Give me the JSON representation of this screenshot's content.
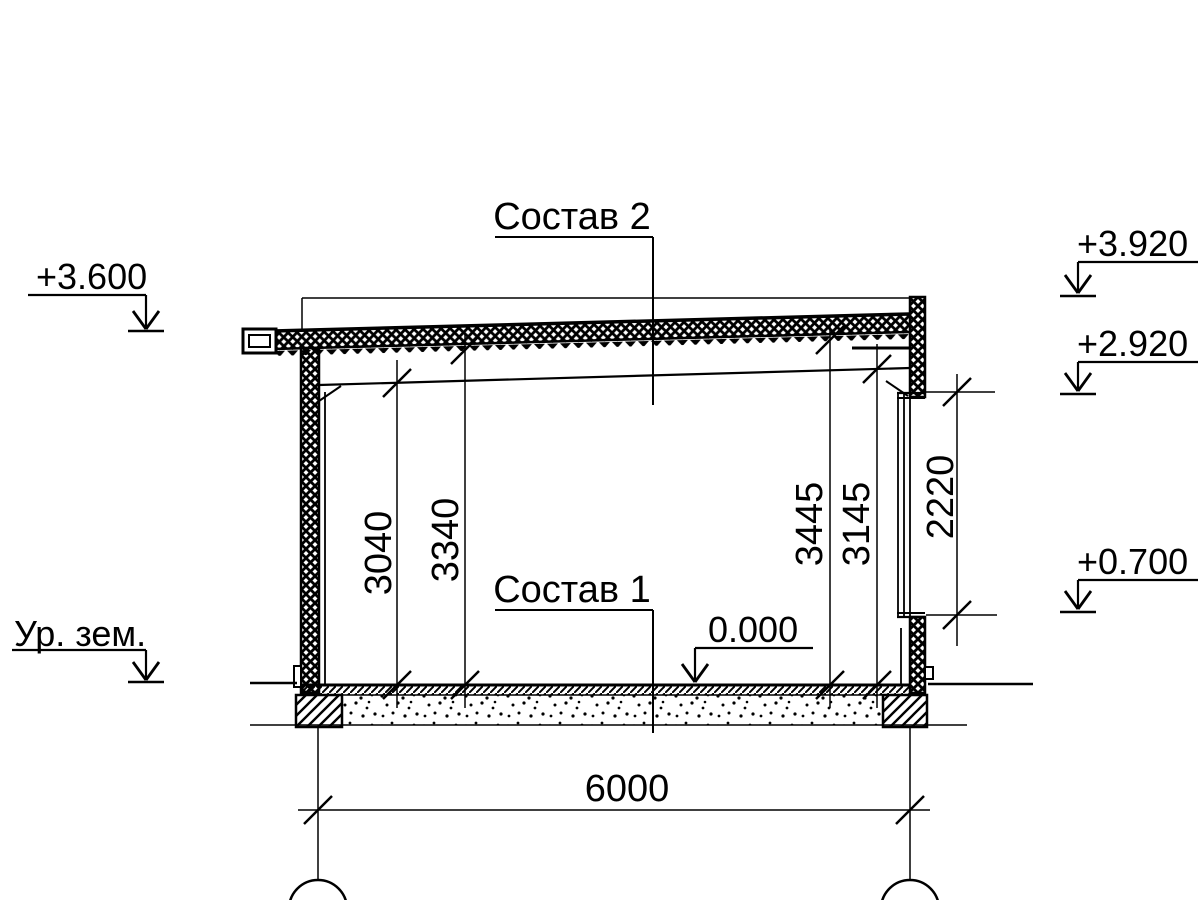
{
  "labels": {
    "composition2": "Состав 2",
    "composition1": "Состав 1",
    "ground_level": "Ур. зем."
  },
  "elevations": {
    "left_roof_top": "+3.600",
    "parapet_top": "+3.920",
    "window_head": "+2.920",
    "window_sill": "+0.700",
    "floor_zero": "0.000"
  },
  "dimensions": {
    "floor_to_ceiling_left": "3040",
    "floor_to_roof_left": "3340",
    "floor_to_roof_right": "3445",
    "floor_to_ceiling_right": "3145",
    "window_opening_height": "2220",
    "axis_span": "6000"
  },
  "colors": {
    "ink": "#000000",
    "paper": "#ffffff"
  }
}
